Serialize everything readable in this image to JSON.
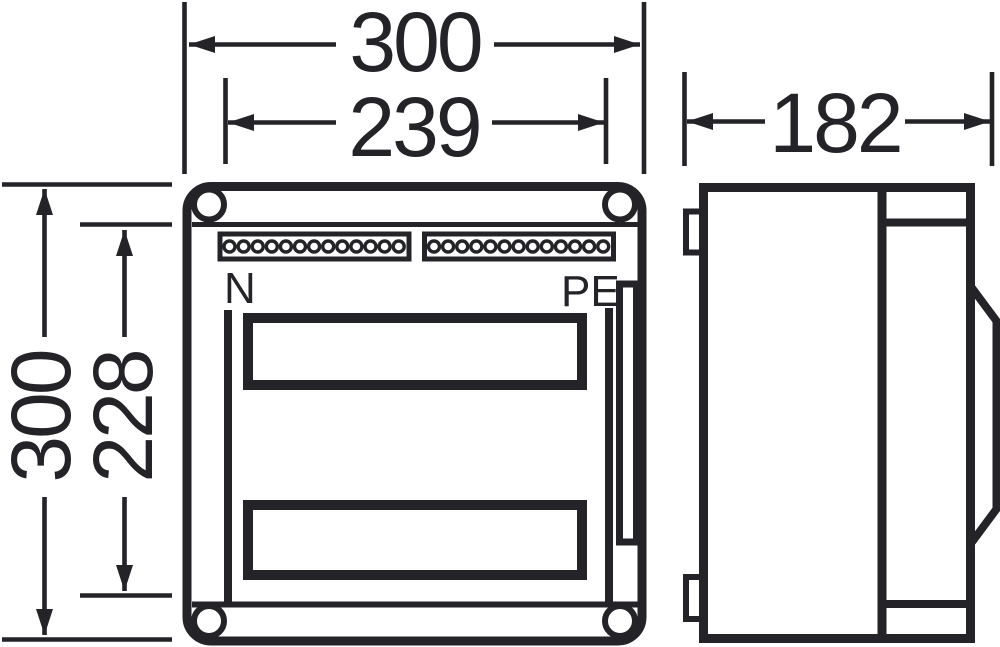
{
  "drawing": {
    "front_view": {
      "neutral_label": "N",
      "pe_label": "PE",
      "terminal_strips": {
        "count": 2,
        "circles_per_strip": 13
      }
    },
    "dimensions_mm": {
      "front_width_overall": "300",
      "front_width_inner": "239",
      "front_height_overall": "300",
      "front_height_inner": "228",
      "side_depth": "182"
    },
    "colors": {
      "line": "#232328",
      "background": "#ffffff"
    }
  }
}
